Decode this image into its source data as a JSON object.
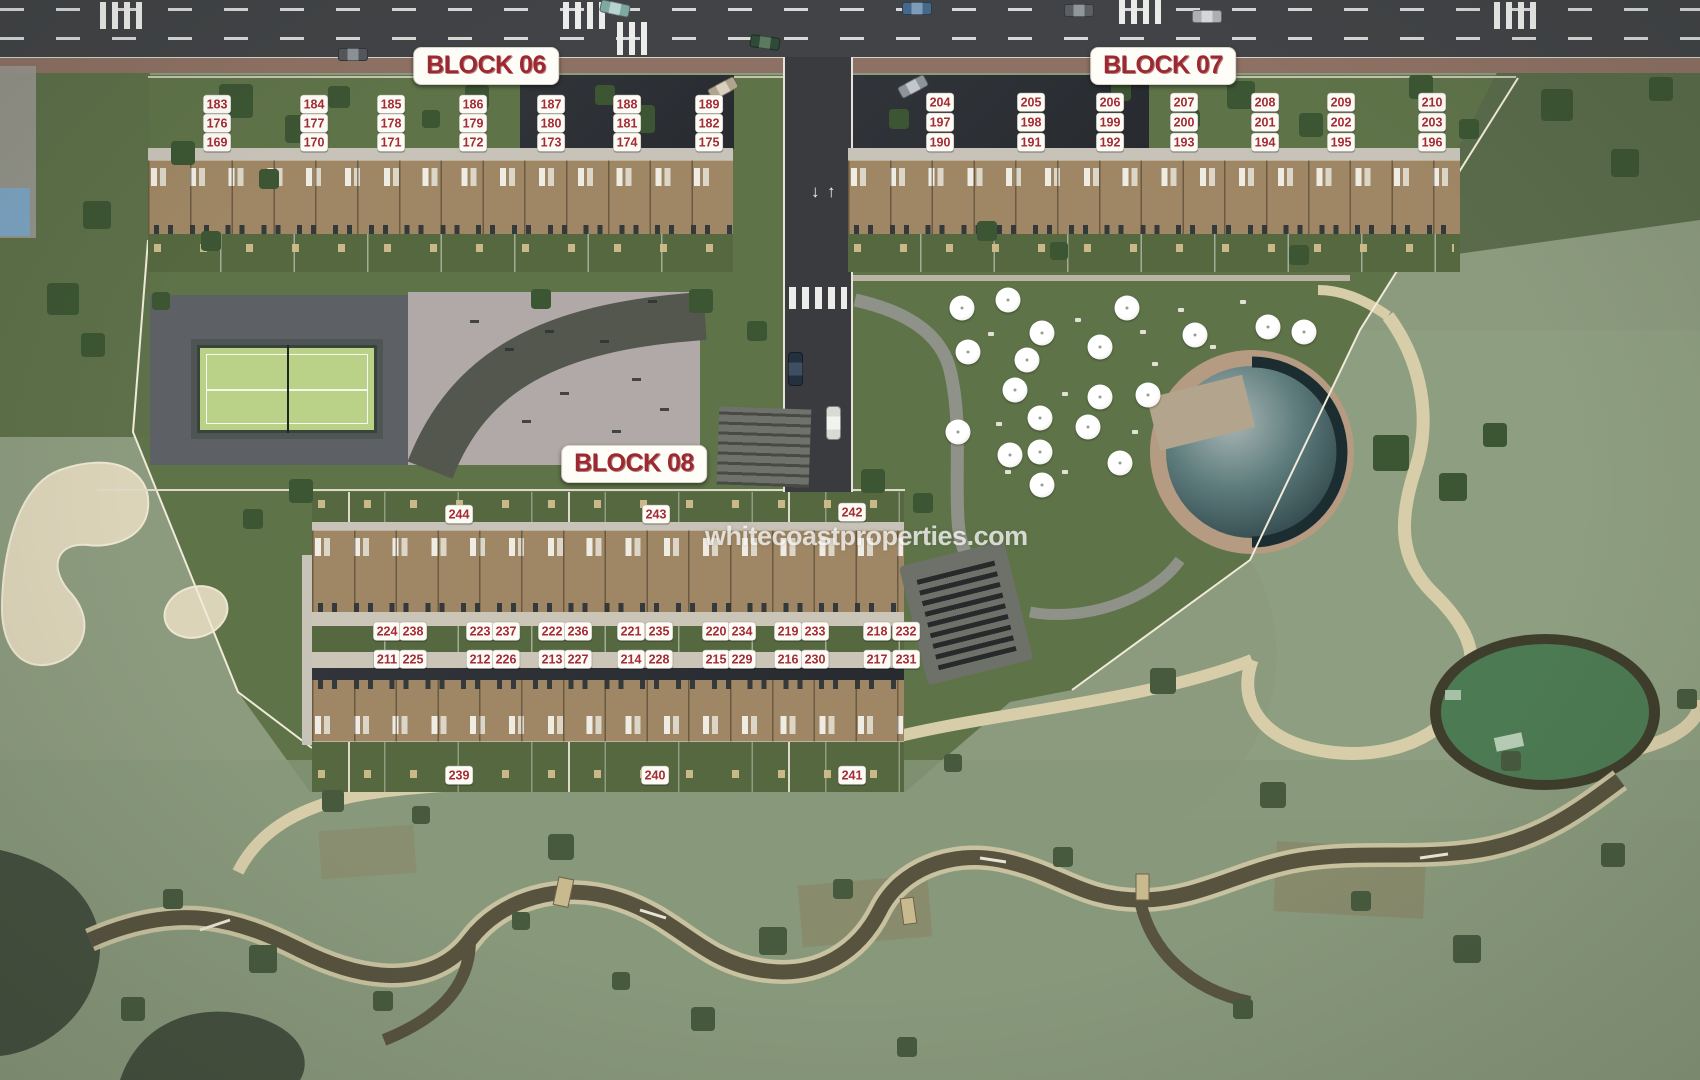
{
  "watermark": {
    "text": "whitecoastproperties.com"
  },
  "road": {
    "arrow_up": "↑",
    "arrow_down": "↓"
  },
  "label_color": "#a32c35",
  "blocks": [
    {
      "name": "BLOCK 06",
      "label_x": 486,
      "label_y": 66,
      "units": [
        {
          "n": "183",
          "x": 217,
          "y": 104
        },
        {
          "n": "184",
          "x": 314,
          "y": 104
        },
        {
          "n": "185",
          "x": 391,
          "y": 104
        },
        {
          "n": "186",
          "x": 473,
          "y": 104
        },
        {
          "n": "187",
          "x": 551,
          "y": 104
        },
        {
          "n": "188",
          "x": 627,
          "y": 104
        },
        {
          "n": "189",
          "x": 709,
          "y": 104
        },
        {
          "n": "176",
          "x": 217,
          "y": 123
        },
        {
          "n": "177",
          "x": 314,
          "y": 123
        },
        {
          "n": "178",
          "x": 391,
          "y": 123
        },
        {
          "n": "179",
          "x": 473,
          "y": 123
        },
        {
          "n": "180",
          "x": 551,
          "y": 123
        },
        {
          "n": "181",
          "x": 627,
          "y": 123
        },
        {
          "n": "182",
          "x": 709,
          "y": 123
        },
        {
          "n": "169",
          "x": 217,
          "y": 142
        },
        {
          "n": "170",
          "x": 314,
          "y": 142
        },
        {
          "n": "171",
          "x": 391,
          "y": 142
        },
        {
          "n": "172",
          "x": 473,
          "y": 142
        },
        {
          "n": "173",
          "x": 551,
          "y": 142
        },
        {
          "n": "174",
          "x": 627,
          "y": 142
        },
        {
          "n": "175",
          "x": 709,
          "y": 142
        }
      ]
    },
    {
      "name": "BLOCK 07",
      "label_x": 1163,
      "label_y": 66,
      "units": [
        {
          "n": "204",
          "x": 940,
          "y": 102
        },
        {
          "n": "205",
          "x": 1031,
          "y": 102
        },
        {
          "n": "206",
          "x": 1110,
          "y": 102
        },
        {
          "n": "207",
          "x": 1184,
          "y": 102
        },
        {
          "n": "208",
          "x": 1265,
          "y": 102
        },
        {
          "n": "209",
          "x": 1341,
          "y": 102
        },
        {
          "n": "210",
          "x": 1432,
          "y": 102
        },
        {
          "n": "197",
          "x": 940,
          "y": 122
        },
        {
          "n": "198",
          "x": 1031,
          "y": 122
        },
        {
          "n": "199",
          "x": 1110,
          "y": 122
        },
        {
          "n": "200",
          "x": 1184,
          "y": 122
        },
        {
          "n": "201",
          "x": 1265,
          "y": 122
        },
        {
          "n": "202",
          "x": 1341,
          "y": 122
        },
        {
          "n": "203",
          "x": 1432,
          "y": 122
        },
        {
          "n": "190",
          "x": 940,
          "y": 142
        },
        {
          "n": "191",
          "x": 1031,
          "y": 142
        },
        {
          "n": "192",
          "x": 1110,
          "y": 142
        },
        {
          "n": "193",
          "x": 1184,
          "y": 142
        },
        {
          "n": "194",
          "x": 1265,
          "y": 142
        },
        {
          "n": "195",
          "x": 1341,
          "y": 142
        },
        {
          "n": "196",
          "x": 1432,
          "y": 142
        }
      ]
    },
    {
      "name": "BLOCK 08",
      "label_x": 634,
      "label_y": 464,
      "units": [
        {
          "n": "244",
          "x": 459,
          "y": 514
        },
        {
          "n": "243",
          "x": 656,
          "y": 514
        },
        {
          "n": "242",
          "x": 852,
          "y": 512
        },
        {
          "n": "224",
          "x": 387,
          "y": 631
        },
        {
          "n": "238",
          "x": 413,
          "y": 631
        },
        {
          "n": "223",
          "x": 480,
          "y": 631
        },
        {
          "n": "237",
          "x": 506,
          "y": 631
        },
        {
          "n": "222",
          "x": 552,
          "y": 631
        },
        {
          "n": "236",
          "x": 578,
          "y": 631
        },
        {
          "n": "221",
          "x": 631,
          "y": 631
        },
        {
          "n": "235",
          "x": 659,
          "y": 631
        },
        {
          "n": "220",
          "x": 716,
          "y": 631
        },
        {
          "n": "234",
          "x": 742,
          "y": 631
        },
        {
          "n": "219",
          "x": 788,
          "y": 631
        },
        {
          "n": "233",
          "x": 815,
          "y": 631
        },
        {
          "n": "218",
          "x": 877,
          "y": 631
        },
        {
          "n": "232",
          "x": 906,
          "y": 631
        },
        {
          "n": "211",
          "x": 387,
          "y": 659
        },
        {
          "n": "225",
          "x": 413,
          "y": 659
        },
        {
          "n": "212",
          "x": 480,
          "y": 659
        },
        {
          "n": "226",
          "x": 506,
          "y": 659
        },
        {
          "n": "213",
          "x": 552,
          "y": 659
        },
        {
          "n": "227",
          "x": 578,
          "y": 659
        },
        {
          "n": "214",
          "x": 631,
          "y": 659
        },
        {
          "n": "228",
          "x": 659,
          "y": 659
        },
        {
          "n": "215",
          "x": 716,
          "y": 659
        },
        {
          "n": "229",
          "x": 742,
          "y": 659
        },
        {
          "n": "216",
          "x": 788,
          "y": 659
        },
        {
          "n": "230",
          "x": 815,
          "y": 659
        },
        {
          "n": "217",
          "x": 877,
          "y": 659
        },
        {
          "n": "231",
          "x": 906,
          "y": 659
        },
        {
          "n": "239",
          "x": 459,
          "y": 775
        },
        {
          "n": "240",
          "x": 655,
          "y": 775
        },
        {
          "n": "241",
          "x": 852,
          "y": 775
        }
      ]
    }
  ]
}
